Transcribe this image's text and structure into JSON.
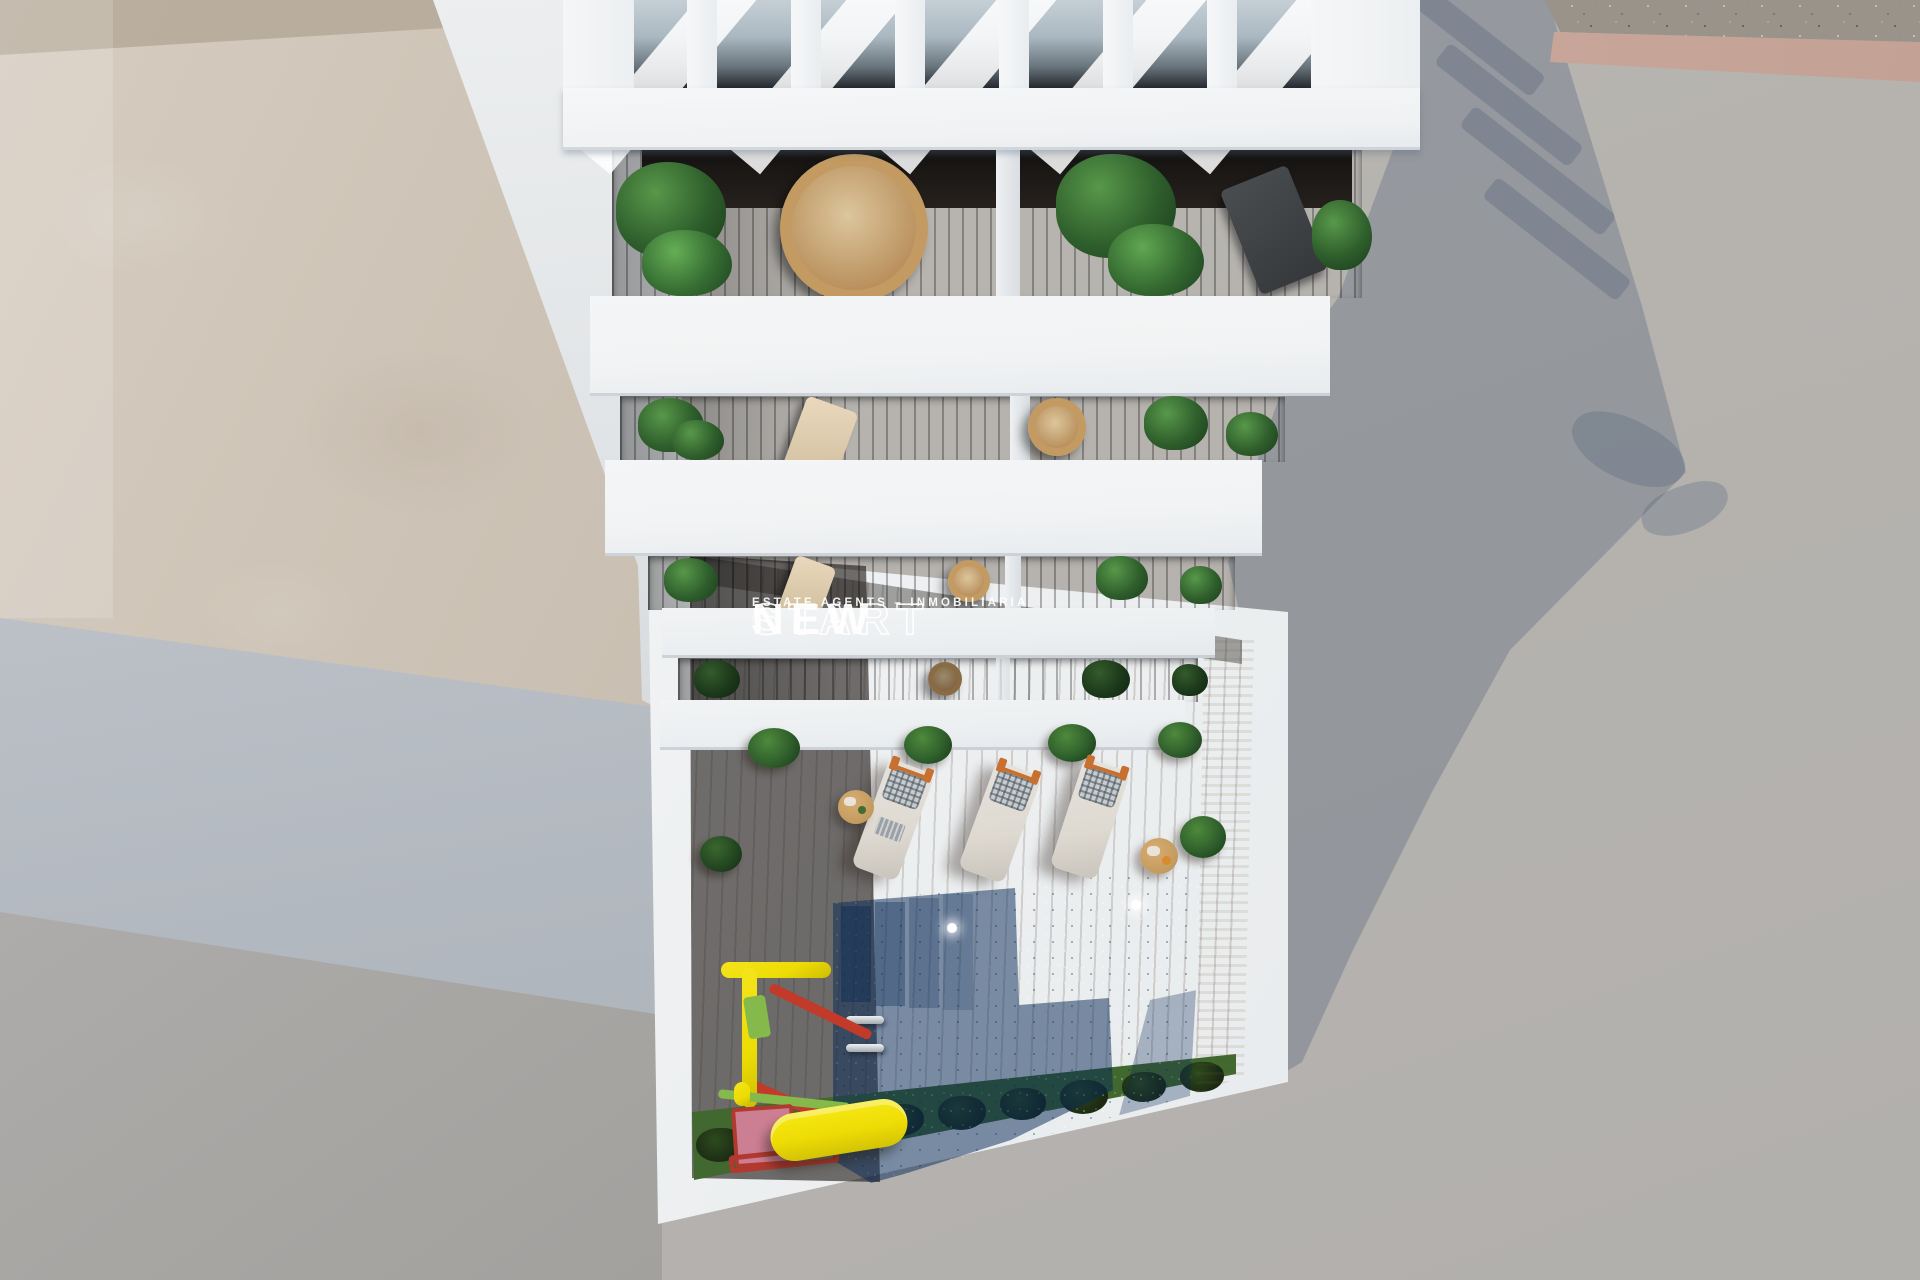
{
  "meta": {
    "type": "architectural-3d-render",
    "view": "aerial top-down",
    "subject": "white apartment building with rooftop pergola, five plant-filled balconies and a courtyard pool terrace"
  },
  "watermark": {
    "brand_bold": "NEW",
    "brand_outline": "START",
    "registered": "®",
    "tagline": "ESTATE AGENTS – INMOBILIARIA"
  },
  "scene": {
    "counts": {
      "balcony_levels": 5,
      "pergola_slats": 7,
      "sun_loungers": 3,
      "side_tables": 2,
      "pool_lights": 2,
      "deck_planters": 6,
      "grass_shrubs": 9
    },
    "objects": [
      "rooftop-pergola",
      "balcony-gardens",
      "hanging-rattan-chairs",
      "sun-loungers",
      "swimming-pool",
      "pool-ladder",
      "pool-steps",
      "kids-playground",
      "yellow-slide",
      "wood-deck",
      "grass-border",
      "gravel-strip",
      "street-pavement",
      "building-shadow"
    ]
  },
  "palette": {
    "pav": "#b6b4b1",
    "pav-sh": "rgba(84,99,122,0.34)",
    "beige": "#cfc5b8",
    "curb": "#c8a79a",
    "wood-lit": "#ae8257",
    "white1": "#f1f3f4",
    "pool-bright": "#27c0e0",
    "pool-sh": "rgba(6,40,85,0.5)",
    "sand": "#dcc596",
    "grass": "#41682f",
    "bush": "#1b2913",
    "rattan": "#c39a62",
    "cushion": "#ded9d1",
    "orange": "#c8702f",
    "table": "#c39a5f",
    "yellow": "#eedc05",
    "red": "#c23b2a",
    "pink": "#cc7f92",
    "pgreen": "#85b94b",
    "leaf": "#2f5f2c",
    "leaf-d": "#1f4420",
    "wm": "rgba(255,255,255,0.93)"
  }
}
